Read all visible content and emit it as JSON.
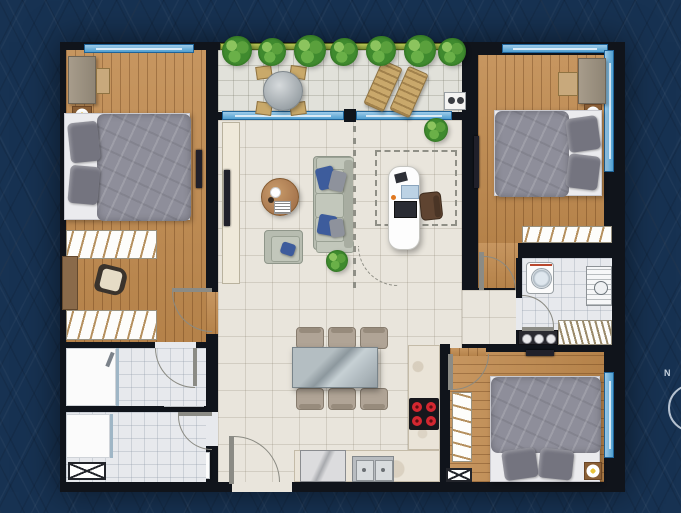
{
  "meta": {
    "type": "apartment-floor-plan",
    "view": "top-down",
    "style": "rendered color plan on dark patterned background"
  },
  "compass": {
    "label": "N"
  },
  "colors": {
    "bg": "#173252",
    "wall": "#10141b",
    "wood": "#c08a4e",
    "bedding": "#8e8e9a",
    "plant": "#3f8a2e",
    "red": "#d42730",
    "window": "#4f9fd0"
  },
  "rooms": [
    {
      "id": "balcony",
      "floor": "tile",
      "furniture": [
        "planter-hedge",
        "round-table",
        "four-chairs",
        "two-sun-loungers",
        "bbq-point"
      ]
    },
    {
      "id": "bedroom-1",
      "floor": "wood",
      "furniture": [
        "double-bed",
        "two-pillows",
        "nightstand-lamp",
        "wardrobe-cabinet",
        "bench",
        "tv",
        "hatched-wardrobe-a",
        "desk",
        "chair",
        "hatched-wardrobe-b"
      ]
    },
    {
      "id": "bathroom-1",
      "floor": "tile",
      "furniture": [
        "shower-tray",
        "floor-drain",
        "glass-screen",
        "toilet",
        "washbasin"
      ]
    },
    {
      "id": "bathroom-2",
      "floor": "tile",
      "furniture": [
        "shower-tray",
        "floor-drain",
        "glass-screen",
        "shaft-box",
        "toilet",
        "washbasin"
      ]
    },
    {
      "id": "living-dining",
      "floor": "tile",
      "furniture": [
        "tv-cabinet",
        "tv",
        "round-coffee-table",
        "sofa",
        "blue-cushions",
        "armchair",
        "potted-plants",
        "dining-table",
        "six-dining-chairs"
      ]
    },
    {
      "id": "multi-purpose-room",
      "floor": "tile",
      "outline": "dashed",
      "furniture": [
        "white-desk",
        "chair",
        "laptop"
      ]
    },
    {
      "id": "kitchen",
      "floor": "tile",
      "furniture": [
        "l-shaped-counter",
        "fridge",
        "double-sink",
        "cooktop-4-burners"
      ]
    },
    {
      "id": "utility-laundry",
      "floor": "tile",
      "furniture": [
        "washing-machine",
        "wall-unit",
        "counter-3-rings",
        "drying-rack"
      ]
    },
    {
      "id": "master-bedroom",
      "floor": "wood",
      "furniture": [
        "double-bed",
        "two-pillows",
        "nightstand-lamp",
        "wardrobe-cabinet",
        "stool",
        "tv",
        "hatched-wardrobe",
        "corner-window"
      ]
    },
    {
      "id": "bedroom-3",
      "floor": "wood",
      "furniture": [
        "double-bed",
        "two-pillows",
        "nightstand-lamp",
        "hatched-wardrobe",
        "shaft-box",
        "tv",
        "window"
      ]
    }
  ]
}
